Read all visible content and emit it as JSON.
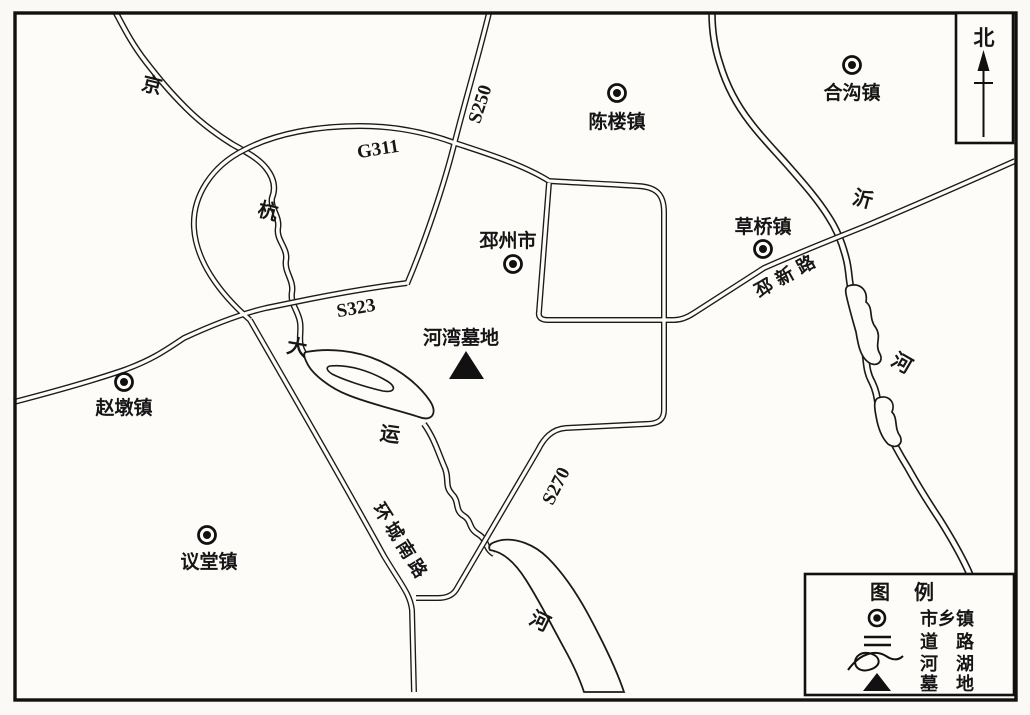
{
  "north": {
    "label": "北"
  },
  "towns": [
    {
      "name": "陈楼镇"
    },
    {
      "name": "合沟镇"
    },
    {
      "name": "草桥镇"
    },
    {
      "name": "邳州市"
    },
    {
      "name": "赵墩镇"
    },
    {
      "name": "议堂镇"
    }
  ],
  "site": {
    "name": "河湾墓地"
  },
  "roads": {
    "g311": "G311",
    "s250": "S250",
    "s323": "S323",
    "s270": "S270",
    "pixin": "邳新路",
    "huancheng": "环城南路"
  },
  "rivers": {
    "canal_chars": [
      "京",
      "杭",
      "大",
      "运",
      "河"
    ],
    "yihe_chars": [
      "沂",
      "河"
    ]
  },
  "legend": {
    "title": "图　例",
    "items": [
      {
        "symbol": "town-marker",
        "label": "市乡镇"
      },
      {
        "symbol": "double-line-road",
        "label": "道　路"
      },
      {
        "symbol": "river-lake",
        "label": "河　湖"
      },
      {
        "symbol": "cemetery-triangle",
        "label": "墓　地"
      }
    ]
  },
  "colors": {
    "ink": "#1a1a1a",
    "paper": "#fdfcf9"
  }
}
